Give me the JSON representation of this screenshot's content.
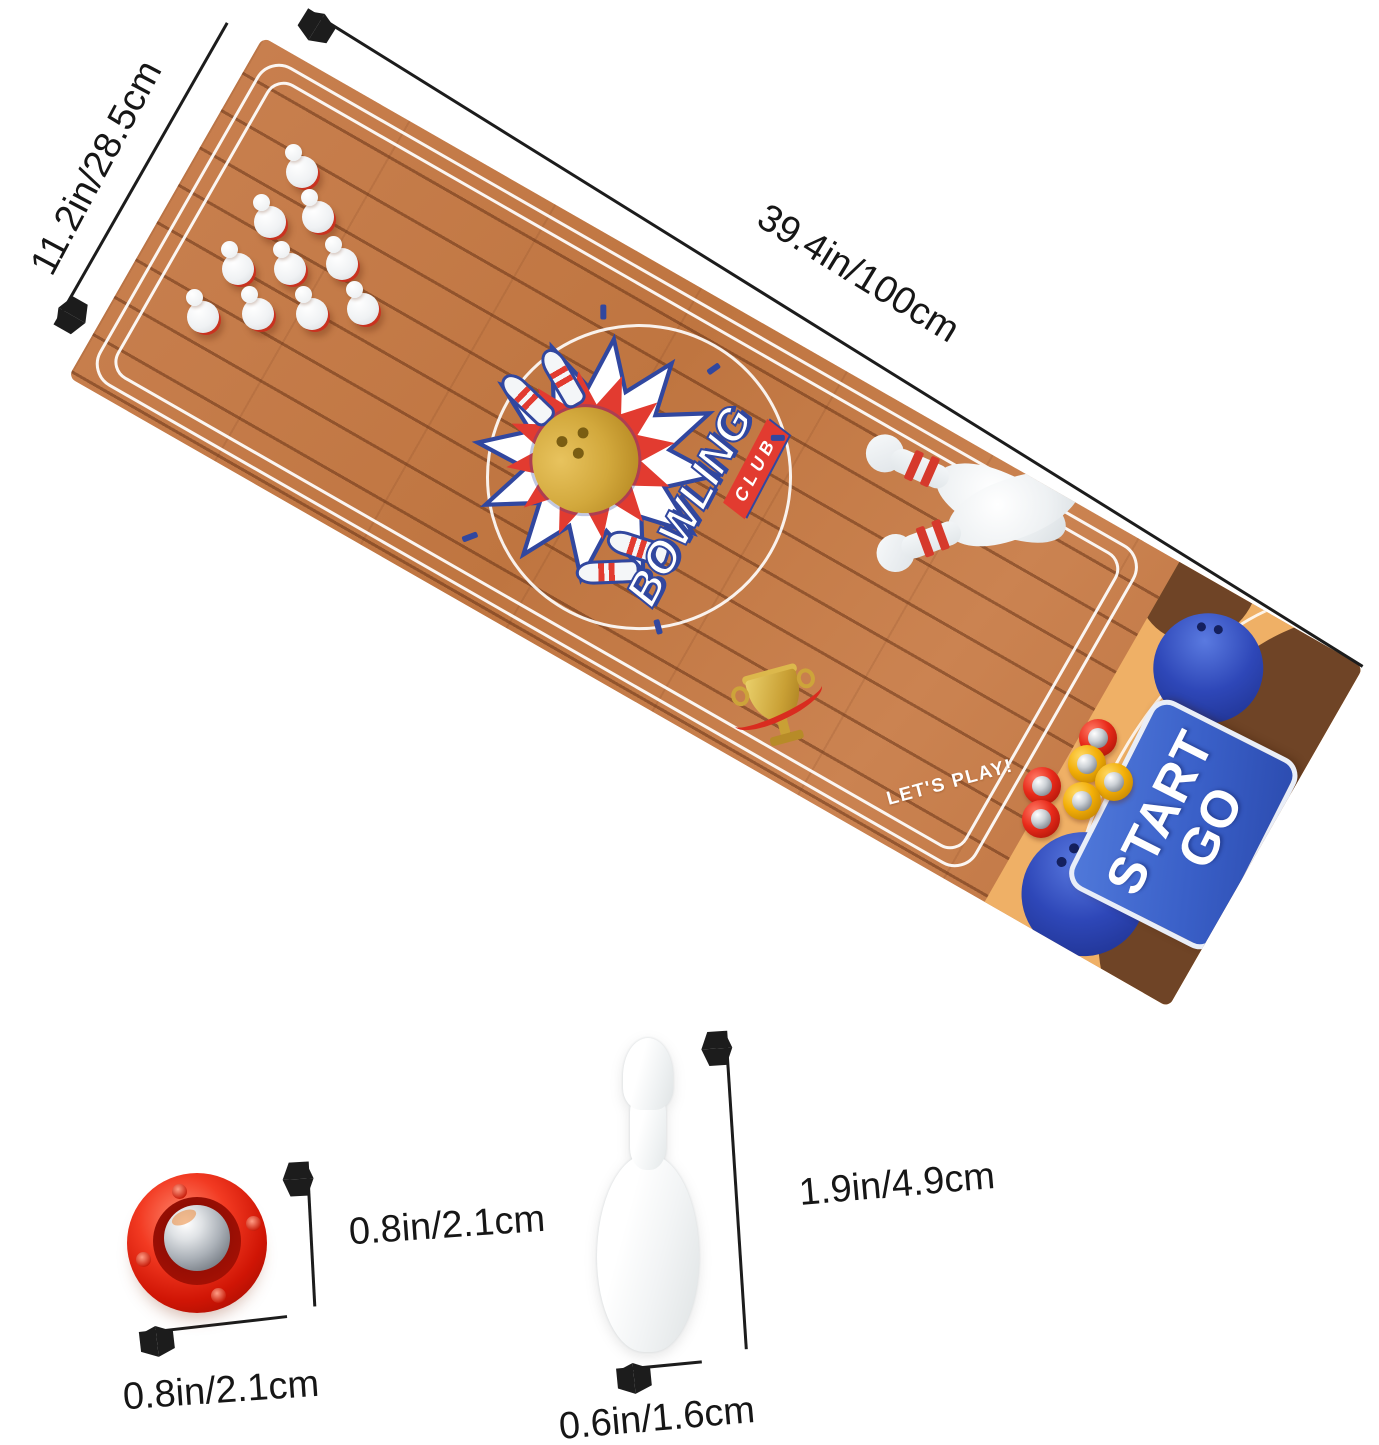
{
  "scene": {
    "description": "Mini tabletop bowling game product photo with dimension annotations",
    "background": "#ffffff"
  },
  "dimensions": {
    "mat_width": "11.2in/28.5cm",
    "mat_length": "39.4in/100cm",
    "puck_height": "0.8in/2.1cm",
    "puck_diameter": "0.8in/2.1cm",
    "pin_height": "1.9in/4.9cm",
    "pin_diameter": "0.6in/1.6cm"
  },
  "mat": {
    "logo": {
      "title": "BOWLING",
      "subtitle": "CLUB"
    },
    "start_sign": {
      "line1": "START",
      "line2": "GO"
    },
    "lets_play": "LET'S PLAY!",
    "pins_on_mat": 10,
    "pucks_on_mat": {
      "red": 3,
      "yellow": 3
    },
    "colors": {
      "lane_wood": "#c27a46",
      "groove": "#8c4e28",
      "start_zone_tan": "#efb066",
      "start_zone_brown": "#6f4426",
      "sign_blue": "#3a60c8",
      "printed_ball_blue": "#2e47b8",
      "logo_gold": "#d2a83c",
      "logo_navy": "#31479f",
      "accent_red": "#e23b30",
      "puck_red": "#e82a1a",
      "puck_yellow": "#f2ae07"
    }
  }
}
